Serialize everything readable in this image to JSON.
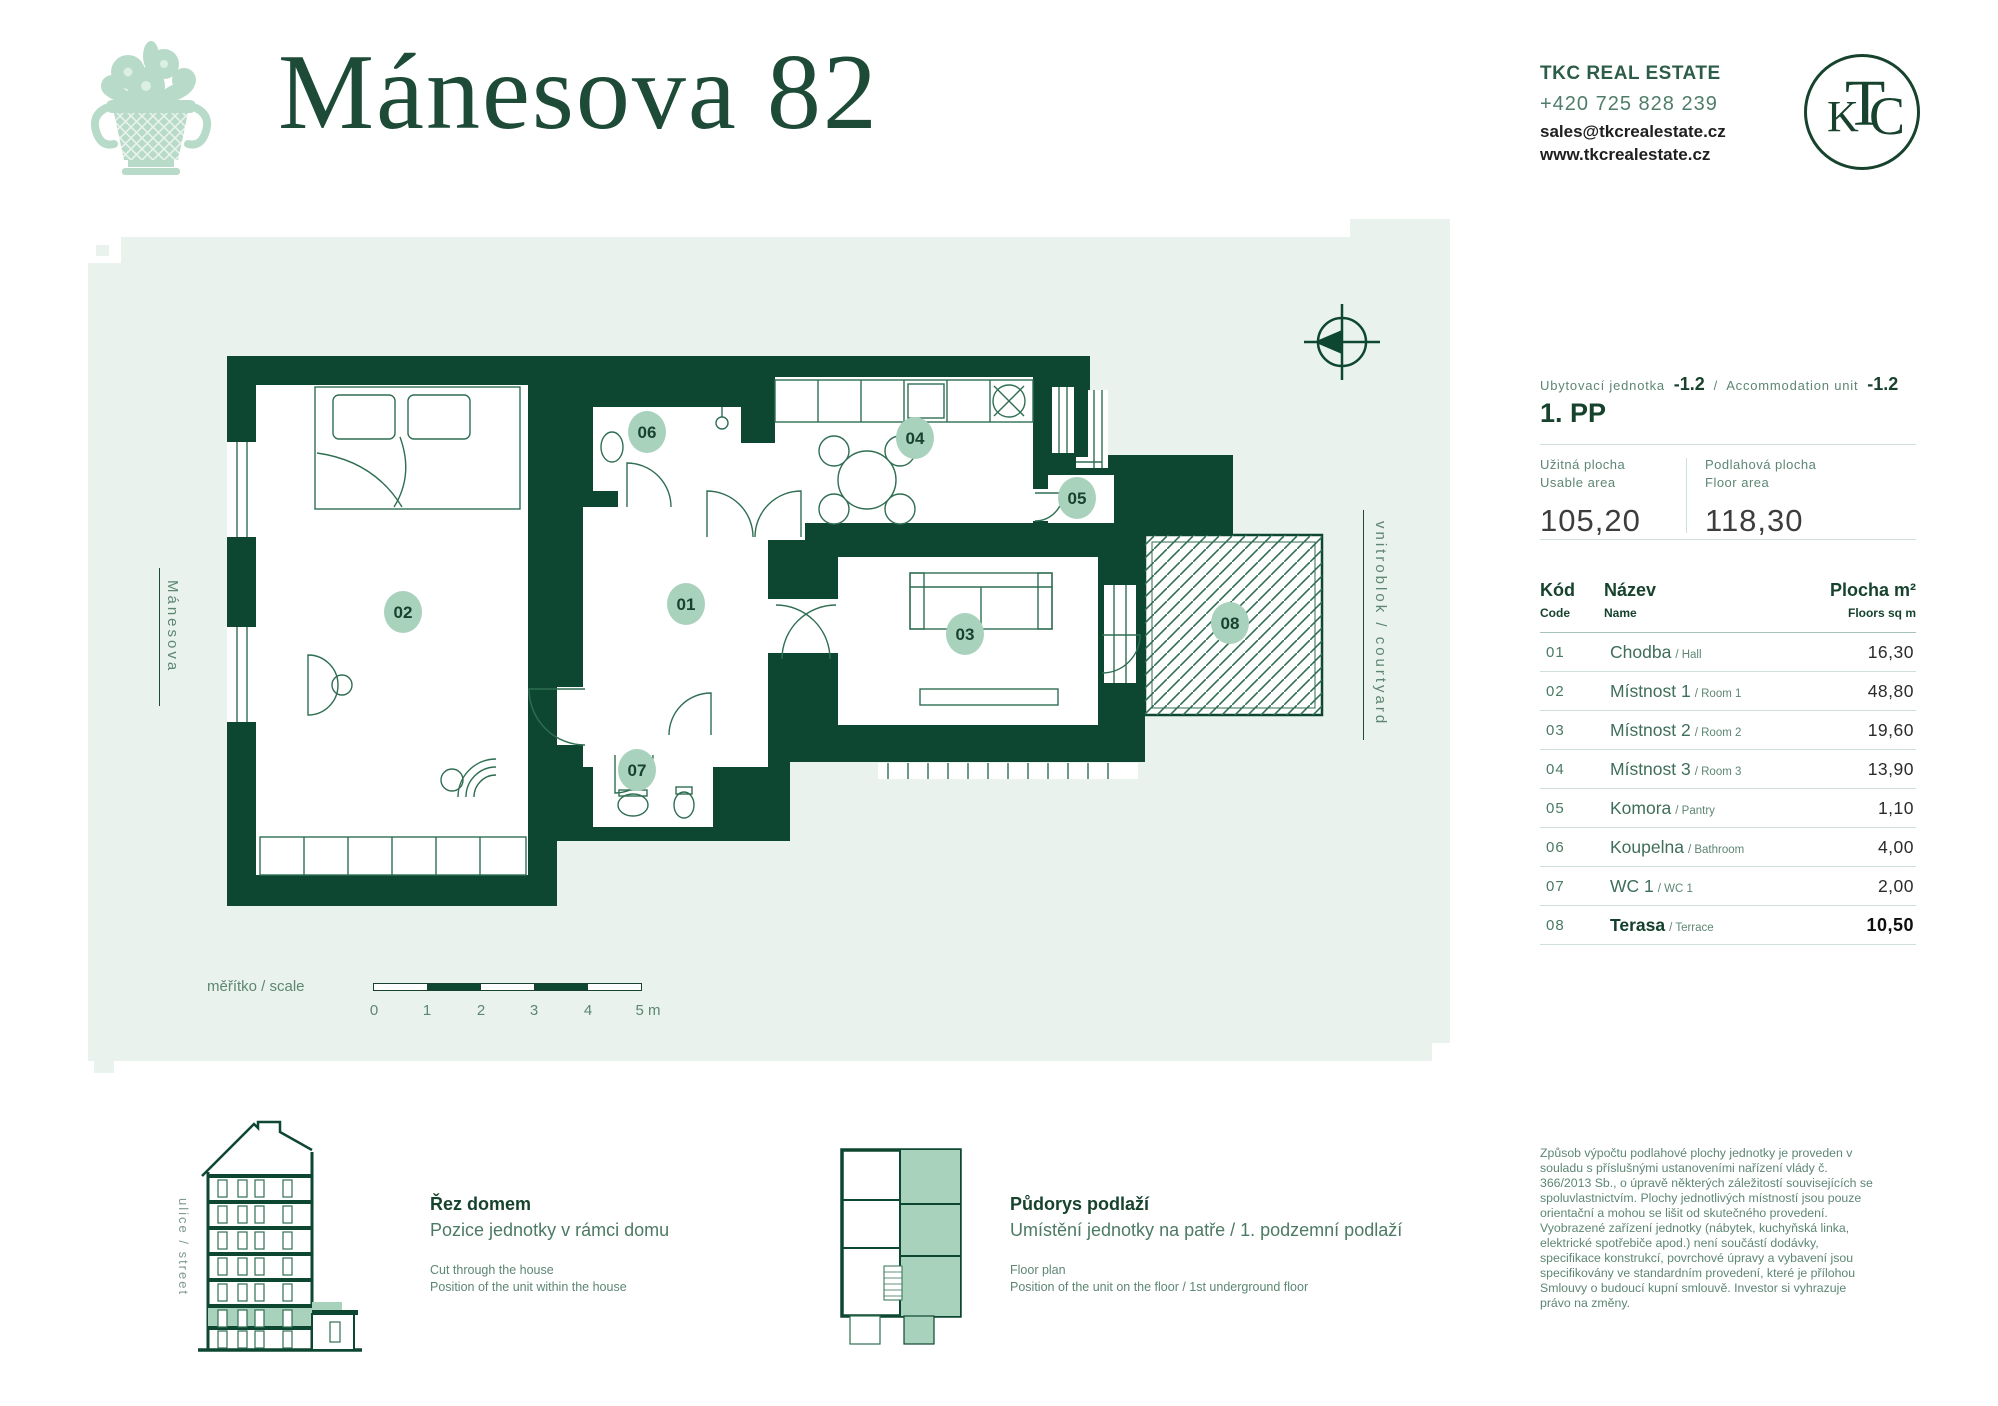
{
  "header": {
    "title": "Mánesova 82",
    "company": "TKC REAL ESTATE",
    "phone": "+420 725 828 239",
    "email": "sales@tkcrealestate.cz",
    "website": "www.tkcrealestate.cz",
    "monogram": {
      "t": "T",
      "k": "K",
      "c": "C"
    }
  },
  "plan": {
    "street_label": "Mánesova",
    "courtyard_label": "vnitroblok / courtyard",
    "badges": [
      "01",
      "02",
      "03",
      "04",
      "05",
      "06",
      "07",
      "08"
    ],
    "scale": {
      "label": "měřítko / scale",
      "ticks": [
        "0",
        "1",
        "2",
        "3",
        "4",
        "5 m"
      ]
    }
  },
  "unit": {
    "cz_label": "Ubytovací jednotka",
    "cz_value": "-1.2",
    "separator": "/",
    "en_label": "Accommodation unit",
    "en_value": "-1.2",
    "floor": "1. PP",
    "areas": {
      "usable": {
        "cz": "Užitná plocha",
        "en": "Usable area",
        "value": "105,20"
      },
      "floor": {
        "cz": "Podlahová plocha",
        "en": "Floor area",
        "value": "118,30"
      }
    },
    "table": {
      "headers": {
        "code_cz": "Kód",
        "code_en": "Code",
        "name_cz": "Název",
        "name_en": "Name",
        "area_cz": "Plocha m²",
        "area_en": "Floors sq m"
      },
      "rows": [
        {
          "code": "01",
          "name": "Chodba",
          "name_en": "/ Hall",
          "area": "16,30"
        },
        {
          "code": "02",
          "name": "Místnost 1",
          "name_en": "/ Room 1",
          "area": "48,80"
        },
        {
          "code": "03",
          "name": "Místnost 2",
          "name_en": "/ Room 2",
          "area": "19,60"
        },
        {
          "code": "04",
          "name": "Místnost 3",
          "name_en": "/ Room 3",
          "area": "13,90"
        },
        {
          "code": "05",
          "name": "Komora",
          "name_en": "/ Pantry",
          "area": "1,10"
        },
        {
          "code": "06",
          "name": "Koupelna",
          "name_en": "/ Bathroom",
          "area": "4,00"
        },
        {
          "code": "07",
          "name": "WC 1",
          "name_en": "/ WC 1",
          "area": "2,00"
        },
        {
          "code": "08",
          "name": "Terasa",
          "name_en": "/ Terrace",
          "area": "10,50"
        }
      ]
    }
  },
  "footer": {
    "section": {
      "title": "Řez domem",
      "subtitle": "Pozice jednotky v rámci domu",
      "en": "Cut through the house\nPosition of the unit within the house",
      "side_label": "ulice / street"
    },
    "floorplan": {
      "title": "Půdorys podlaží",
      "subtitle": "Umístění jednotky na patře / 1. podzemní podlaží",
      "en": "Floor plan\nPosition of the unit on the floor / 1st underground floor"
    },
    "disclaimer": "Způsob výpočtu podlahové plochy jednotky je proveden v souladu s příslušnými ustanoveními nařízení vlády č. 366/2013 Sb., o úpravě některých záležitostí souvisejících se spoluvlastnictvím. Plochy jednotlivých místností jsou pouze orientační a mohou se lišit od skutečného provedení. Vyobrazené zařízení jednotky (nábytek, kuchyňská linka, elektrické spotřebiče apod.) není součástí dodávky, specifikace konstrukcí, povrchové úpravy a vybavení jsou specifikovány ve standardním provedení, které je přílohou Smlouvy o budoucí kupní smlouvě. Investor si vyhrazuje právo na změny."
  },
  "colors": {
    "wall_green": "#0e4731",
    "heading_green": "#17432e",
    "badge_green": "#a9d2bc",
    "logo_green": "#b7dbc8",
    "plan_bg": "#e9f2ed",
    "muted_green": "#5d8673"
  }
}
